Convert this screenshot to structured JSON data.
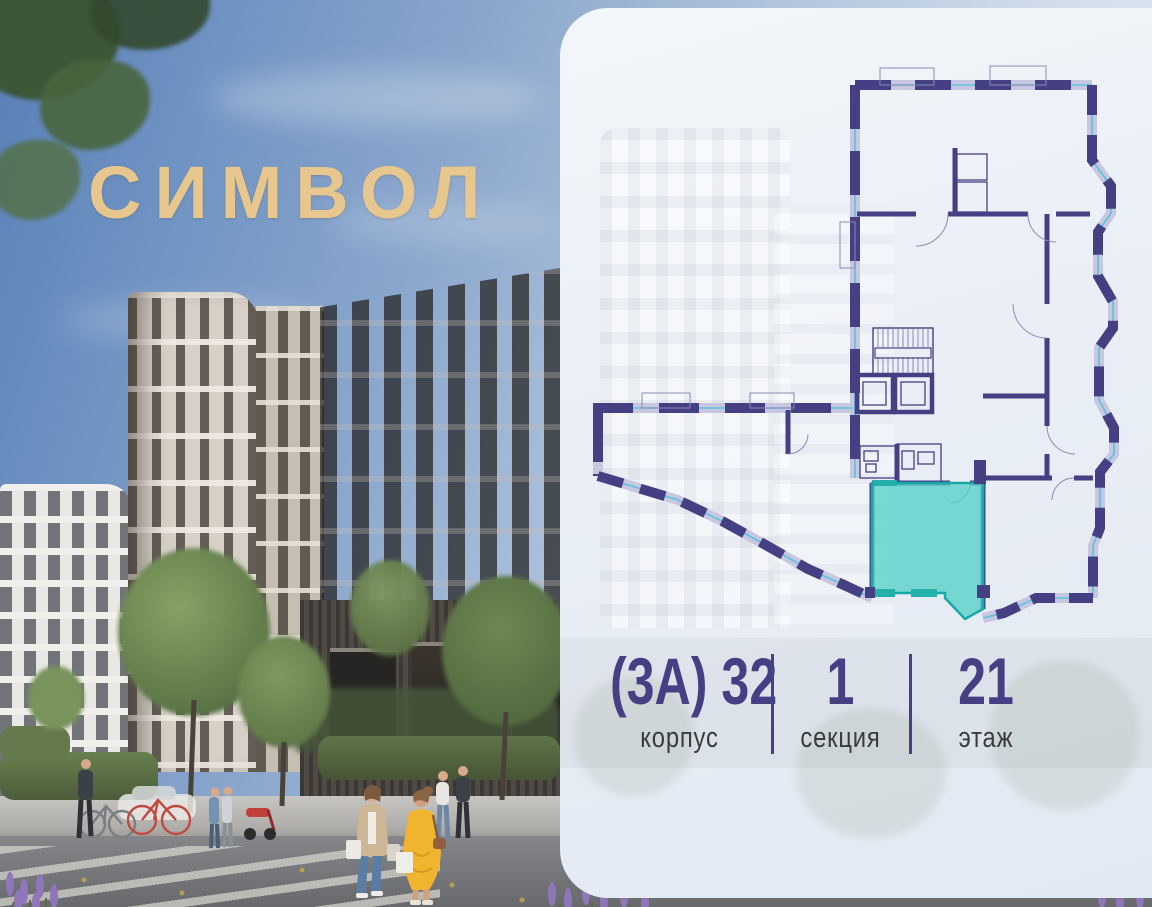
{
  "brand": {
    "logo_text": "СИМВОЛ",
    "logo_color": "#e8c78f"
  },
  "card": {
    "details": [
      {
        "value": "(3А) 32",
        "label": "корпус"
      },
      {
        "value": "1",
        "label": "секция"
      },
      {
        "value": "21",
        "label": "этаж"
      }
    ],
    "accent_color": "#454084",
    "label_color": "#3b3b3d",
    "background_color": "#eaeff6"
  },
  "floorplan": {
    "wall_color": "#454083",
    "window_color": "#58c3de",
    "highlight_fill": "#56cfc7",
    "highlight_stroke": "#18a8a5",
    "highlighted_units": 1
  },
  "photo": {
    "scene": "residential-complex-street-view",
    "sky_color": "#6f93c2",
    "gold_color": "#e8c78f"
  }
}
